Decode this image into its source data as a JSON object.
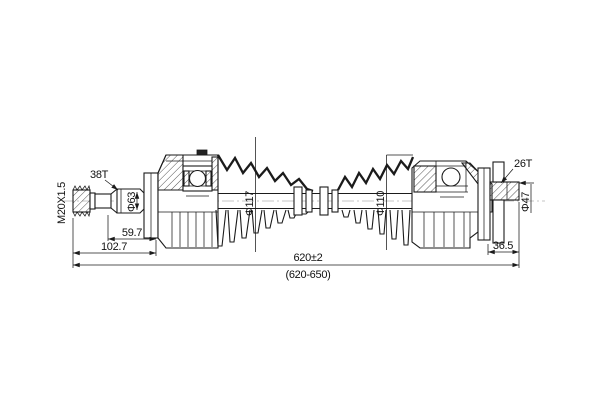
{
  "drawing": {
    "background": "#ffffff",
    "line_color": "#1b1b1b",
    "labels": {
      "thread_spec": "M20X1.5",
      "left_spline_teeth": "38T",
      "left_shaft_dia": "Φ63",
      "left_joint_dia": "Φ117",
      "right_boot_dia": "Φ110",
      "right_spline_teeth": "26T",
      "right_stub_dia": "Φ47"
    },
    "dimensions": {
      "left_spline_length": "59.7",
      "left_stub_length": "102.7",
      "right_stub_length": "36.5",
      "overall_length": "620±2",
      "overall_length_range": "(620-650)"
    }
  }
}
